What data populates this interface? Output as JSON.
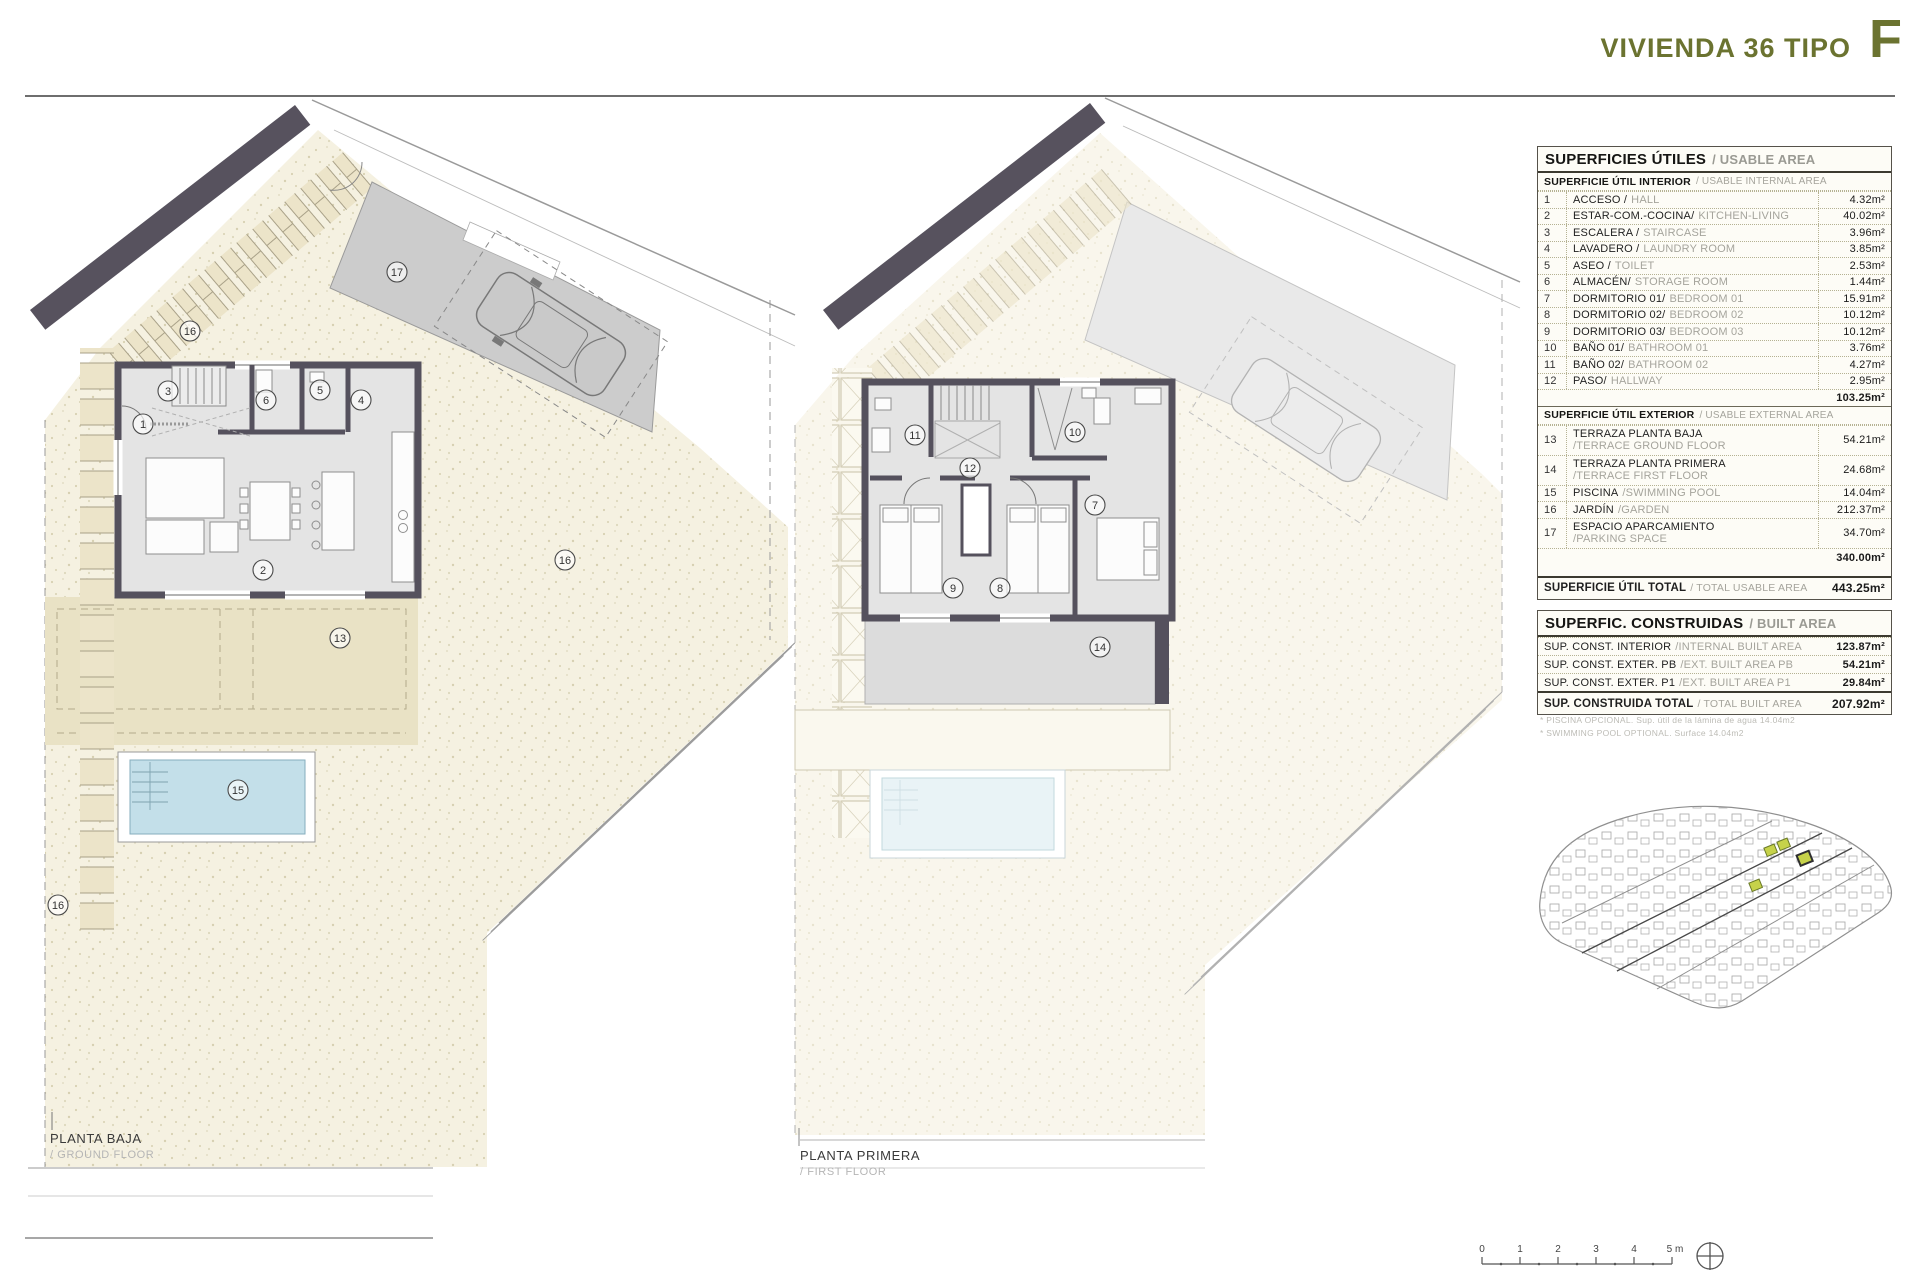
{
  "header": {
    "title": "VIVIENDA 36 TIPO",
    "letter": "F"
  },
  "plans": [
    {
      "label_es": "PLANTA BAJA",
      "label_en": "/ GROUND FLOOR"
    },
    {
      "label_es": "PLANTA PRIMERA",
      "label_en": "/ FIRST FLOOR"
    }
  ],
  "usable": {
    "title_es": "SUPERFICIES ÚTILES",
    "title_en": "/ USABLE AREA",
    "interior_head_es": "SUPERFICIE ÚTIL INTERIOR",
    "interior_head_en": "/ USABLE INTERNAL AREA",
    "interior_rows": [
      {
        "num": "1",
        "es": "ACCESO /",
        "en": "HALL",
        "value": "4.32m²"
      },
      {
        "num": "2",
        "es": "ESTAR-COM.-COCINA/",
        "en": "KITCHEN-LIVING",
        "value": "40.02m²"
      },
      {
        "num": "3",
        "es": "ESCALERA /",
        "en": "STAIRCASE",
        "value": "3.96m²"
      },
      {
        "num": "4",
        "es": "LAVADERO /",
        "en": "LAUNDRY ROOM",
        "value": "3.85m²"
      },
      {
        "num": "5",
        "es": "ASEO /",
        "en": "TOILET",
        "value": "2.53m²"
      },
      {
        "num": "6",
        "es": "ALMACÉN/",
        "en": "STORAGE ROOM",
        "value": "1.44m²"
      },
      {
        "num": "7",
        "es": "DORMITORIO 01/",
        "en": "BEDROOM 01",
        "value": "15.91m²"
      },
      {
        "num": "8",
        "es": "DORMITORIO 02/",
        "en": "BEDROOM 02",
        "value": "10.12m²"
      },
      {
        "num": "9",
        "es": "DORMITORIO 03/",
        "en": "BEDROOM 03",
        "value": "10.12m²"
      },
      {
        "num": "10",
        "es": "BAÑO 01/",
        "en": "BATHROOM 01",
        "value": "3.76m²"
      },
      {
        "num": "11",
        "es": "BAÑO 02/",
        "en": "BATHROOM 02",
        "value": "4.27m²"
      },
      {
        "num": "12",
        "es": "PASO/",
        "en": "HALLWAY",
        "value": "2.95m²"
      }
    ],
    "interior_subtotal": "103.25m²",
    "exterior_head_es": "SUPERFICIE ÚTIL EXTERIOR",
    "exterior_head_en": "/ USABLE EXTERNAL AREA",
    "exterior_rows": [
      {
        "num": "13",
        "es": "TERRAZA PLANTA BAJA",
        "en": "/TERRACE GROUND FLOOR",
        "value": "54.21m²"
      },
      {
        "num": "14",
        "es": "TERRAZA PLANTA PRIMERA",
        "en": "/TERRACE FIRST FLOOR",
        "value": "24.68m²"
      },
      {
        "num": "15",
        "es": "PISCINA",
        "en": "/SWIMMING POOL",
        "value": "14.04m²"
      },
      {
        "num": "16",
        "es": "JARDÍN",
        "en": "/GARDEN",
        "value": "212.37m²"
      },
      {
        "num": "17",
        "es": "ESPACIO APARCAMIENTO",
        "en": "/PARKING SPACE",
        "value": "34.70m²"
      }
    ],
    "exterior_subtotal": "340.00m²",
    "total_es": "SUPERFICIE ÚTIL TOTAL",
    "total_en": "/ TOTAL USABLE AREA",
    "total_value": "443.25m²"
  },
  "built": {
    "title_es": "SUPERFIC. CONSTRUIDAS",
    "title_en": "/ BUILT AREA",
    "rows": [
      {
        "es": "SUP. CONST. INTERIOR",
        "en": "/INTERNAL BUILT AREA",
        "value": "123.87m²"
      },
      {
        "es": "SUP. CONST. EXTER. PB",
        "en": "/EXT. BUILT AREA PB",
        "value": "54.21m²"
      },
      {
        "es": "SUP. CONST. EXTER. P1",
        "en": "/EXT. BUILT AREA P1",
        "value": "29.84m²"
      }
    ],
    "total_es": "SUP. CONSTRUIDA TOTAL",
    "total_en": "/ TOTAL BUILT AREA",
    "total_value": "207.92m²"
  },
  "footnotes": [
    "* PISCINA OPCIONAL. Sup. útil de la lámina de agua 14.04m2",
    "* SWIMMING POOL OPTIONAL. Surface 14.04m2"
  ],
  "scale": [
    "0",
    "1",
    "2",
    "3",
    "4",
    "5 m"
  ],
  "nums": {
    "ground": [
      "1",
      "2",
      "3",
      "4",
      "5",
      "6",
      "13",
      "15",
      "16",
      "16",
      "16",
      "17"
    ],
    "first": [
      "7",
      "8",
      "9",
      "10",
      "11",
      "12",
      "14"
    ]
  },
  "colors": {
    "accent_olive": "#6b7330",
    "wall": "#55515d",
    "garden": "#f5f1e1",
    "terrace": "#e9e2c5",
    "pool_water": "#c3dfe9",
    "parking": "#cccccc",
    "site_highlight": "#c6d24a"
  }
}
